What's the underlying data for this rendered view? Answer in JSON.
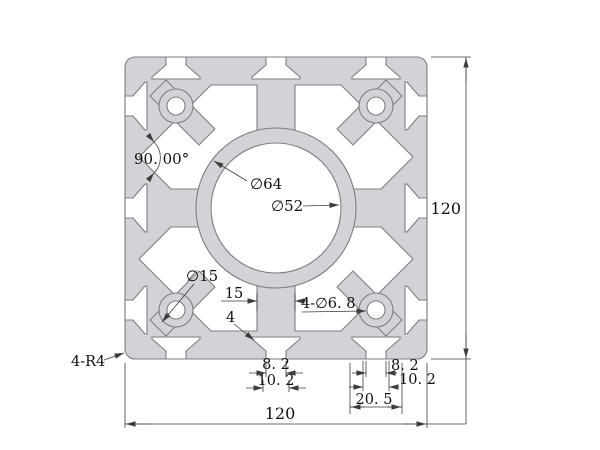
{
  "labels": {
    "angle": "90. 00°",
    "dia_ring": "∅64",
    "dia_bore": "∅52",
    "dia_boss": "∅15",
    "web_width": "15",
    "wall_thickness": "4",
    "corner_holes": "4-∅6. 8",
    "corner_radius": "4-R4",
    "slot_center_opening": "8. 2",
    "slot_center_width": "10. 2",
    "slot_right_opening": "8. 2",
    "slot_right_width": "10. 2",
    "slot_right_span": "20. 5",
    "overall_height": "120",
    "overall_width": "120"
  },
  "colors": {
    "profile_fill": "#d2d3d6",
    "profile_line": "#7d7d85",
    "dim_line": "#3c3c3c",
    "text": "#111111",
    "background": "#ffffff"
  }
}
